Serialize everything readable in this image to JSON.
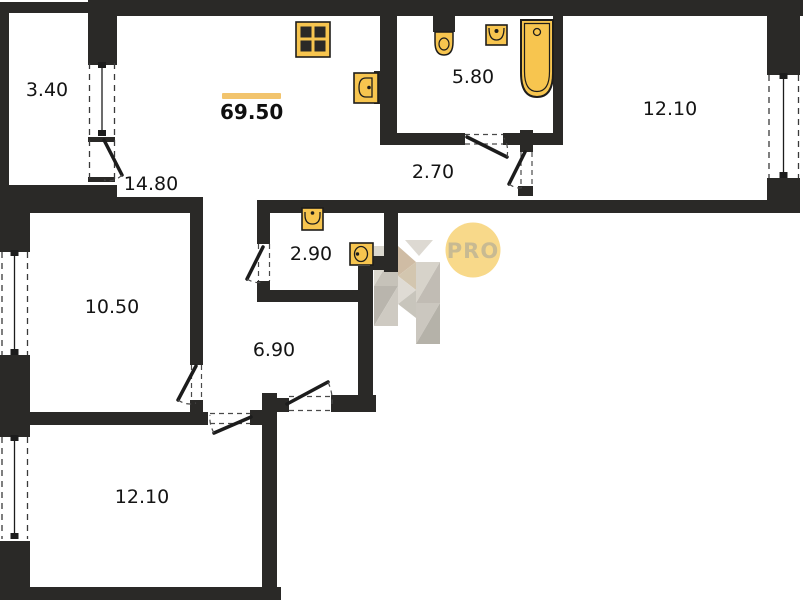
{
  "plan": {
    "type": "apartment-floor-plan",
    "total_area": {
      "value": "69.50"
    },
    "rooms": {
      "balcony": {
        "area": "3.40"
      },
      "living_kitchen": {
        "area": "14.80"
      },
      "bathroom": {
        "area": "5.80"
      },
      "bedroom_right": {
        "area": "12.10"
      },
      "hall_upper": {
        "area": "2.70"
      },
      "wc": {
        "area": "2.90"
      },
      "bedroom_left": {
        "area": "10.50"
      },
      "hallway": {
        "area": "6.90"
      },
      "bedroom_bottom": {
        "area": "12.10"
      }
    },
    "fixtures": [
      {
        "name": "stove-icon"
      },
      {
        "name": "kitchen-sink-icon"
      },
      {
        "name": "toilet-icon"
      },
      {
        "name": "washbasin-icon"
      },
      {
        "name": "bathtub-icon"
      },
      {
        "name": "wc-washbasin-icon"
      },
      {
        "name": "wc-sink-icon"
      }
    ],
    "watermark": {
      "badge_text": "PRO",
      "logo": "h-logo"
    },
    "colors": {
      "wall": "#2a2927",
      "fixture": "#f7c54f",
      "fixture-outline": "#1e1d1b",
      "accent": "#f2c46d",
      "badge-bg": "#f8d98a",
      "badge-text": "#c8ba92"
    }
  }
}
